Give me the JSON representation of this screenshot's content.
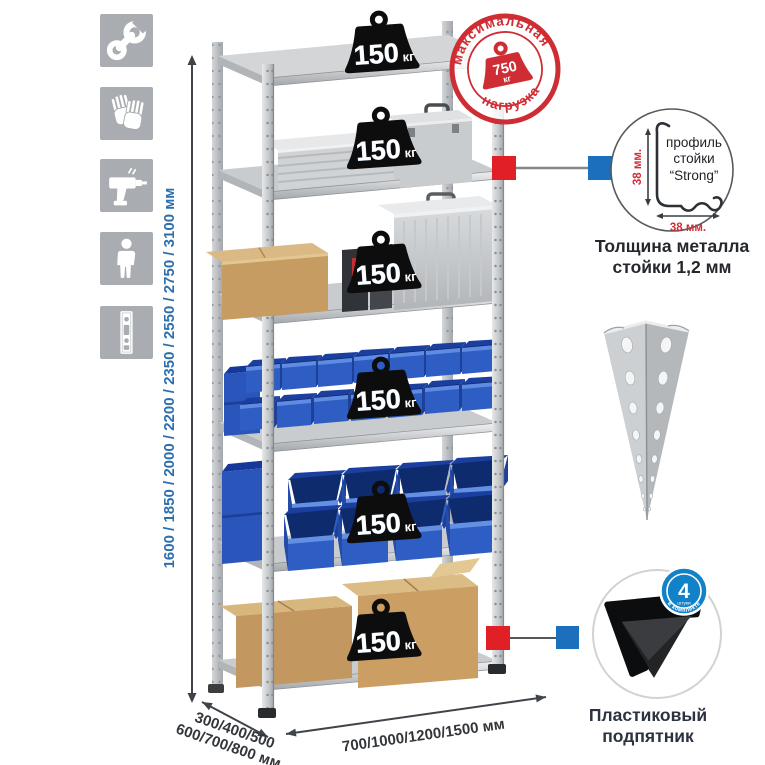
{
  "sidebar": {
    "icons": [
      {
        "name": "wrench"
      },
      {
        "name": "gloves"
      },
      {
        "name": "drill"
      },
      {
        "name": "person"
      },
      {
        "name": "rack-post"
      }
    ]
  },
  "dimensions": {
    "height_label": "1600 / 1850 / 2000 / 2200 / 2350 / 2550 / 2750 / 3100 мм",
    "depth_line1": "300/400/500",
    "depth_line2": "600/700/800 мм",
    "width_label": "700/1000/1200/1500 мм"
  },
  "max_load_stamp": {
    "arc_top": "максимальная",
    "arc_bottom": "нагрузка",
    "value": "750",
    "unit": "кг"
  },
  "shelf_loads": [
    {
      "value": "150",
      "unit": "кг"
    },
    {
      "value": "150",
      "unit": "кг"
    },
    {
      "value": "150",
      "unit": "кг"
    },
    {
      "value": "150",
      "unit": "кг"
    },
    {
      "value": "150",
      "unit": "кг"
    },
    {
      "value": "150",
      "unit": "кг"
    }
  ],
  "profile_detail": {
    "vertical_dim": "38 мм.",
    "horizontal_dim": "38 мм.",
    "label_line1": "профиль",
    "label_line2": "стойки",
    "label_line3": "“Strong”",
    "caption_line1": "Толщина металла",
    "caption_line2": "стойки 1,2 мм"
  },
  "foot_detail": {
    "badge_value": "4",
    "badge_unit": "штуки",
    "badge_arc": "в комплекте",
    "caption_line1": "Пластиковый",
    "caption_line2": "подпятник"
  },
  "colors": {
    "accent_red": "#d6232b",
    "accent_blue": "#1c6fbd",
    "dim_text_blue": "#2d6fad",
    "bin_blue": "#2e5ec4",
    "icon_gray": "#a9adb1"
  }
}
